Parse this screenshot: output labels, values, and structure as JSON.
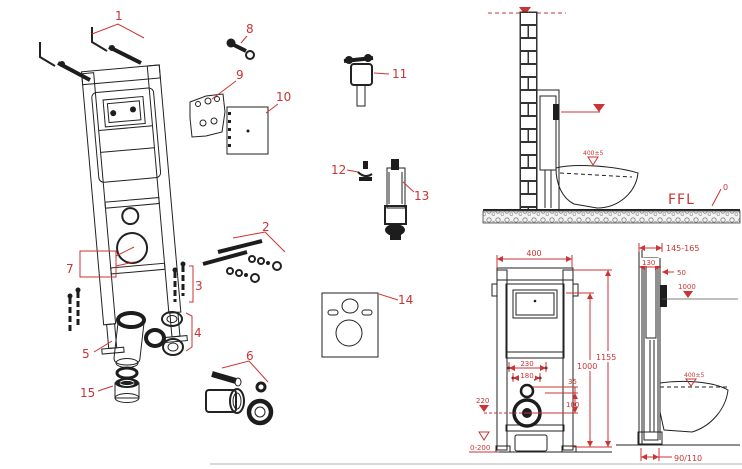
{
  "diagram": {
    "title_hint": "wall-hung-toilet-frame-exploded-and-installation-drawing",
    "callouts": [
      "1",
      "2",
      "3",
      "4",
      "5",
      "6",
      "7",
      "8",
      "9",
      "10",
      "11",
      "12",
      "13",
      "14",
      "15"
    ]
  },
  "side_install": {
    "ffl": "FFL",
    "ffl_zero": "0",
    "seat_height": "400±5"
  },
  "front_view": {
    "width": "400",
    "total_height": "1155",
    "flush_height": "1000",
    "bracket_width": "230",
    "bolt_width": "180",
    "offset_35": "35",
    "offset_100": "100",
    "outlet_height": "220",
    "adjust_range": "0-200"
  },
  "side_view": {
    "depth_range": "145-165",
    "depth_130": "130",
    "plate_offset": "50",
    "plate_height": "1000",
    "seat_height": "400±5",
    "outlet_diameter": "90/110"
  },
  "colors": {
    "annotation_red": "#cc3333",
    "line_black": "#222222",
    "background": "#ffffff"
  }
}
